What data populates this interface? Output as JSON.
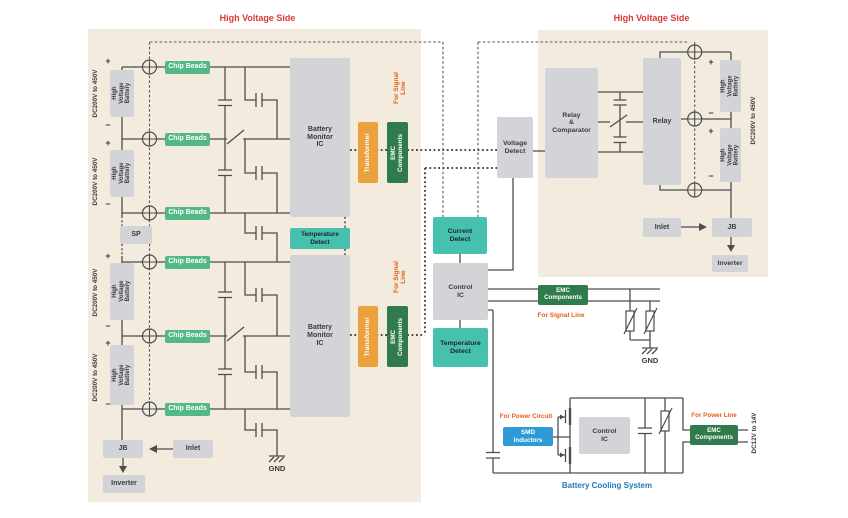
{
  "left": {
    "title": "High Voltage Side",
    "dc_range": "DC200V to 450V",
    "battery": "High Voltage\nBattery",
    "chip_beads": "Chip Beads",
    "sp": "SP",
    "bmic": "Battery\nMonitor\nIC",
    "temp_detect": "Temperature\nDetect",
    "transformer": "Transformer",
    "emc": "EMC\nComponents",
    "signal_line": "For Signal Line",
    "jb": "JB",
    "inlet": "Inlet",
    "inverter": "Inverter",
    "gnd": "GND"
  },
  "middle": {
    "voltage_detect": "Voltage\nDetect",
    "current_detect": "Current\nDetect",
    "control_ic": "Control\nIC",
    "temp_detect": "Temperature\nDetect",
    "emc": "EMC\nComponents",
    "signal_line": "For Signal Line",
    "gnd": "GND"
  },
  "right": {
    "title": "High Voltage Side",
    "relay_comparator": "Relay\n&\nComparator",
    "relay": "Relay",
    "battery": "High Voltage\nBattery",
    "dc_range": "DC200V to 450V",
    "inlet": "Inlet",
    "jb": "JB",
    "inverter": "Inverter"
  },
  "cooling": {
    "title": "Battery Cooling System",
    "power_circuit": "For Power Circuit",
    "smd": "SMD\nInductors",
    "control_ic": "Control\nIC",
    "power_line": "For Power Line",
    "emc": "EMC\nComponents",
    "dc_range": "DC12V to 14V"
  },
  "sym": {
    "plus": "+",
    "minus": "−"
  },
  "colors": {
    "beige": "#F2EBDE",
    "box_gray": "#D2D4D8",
    "box_teal": "#46C1AD",
    "box_green": "#54B788",
    "box_dgreen": "#2F7B4C",
    "box_orange": "#EBA23E",
    "box_blue": "#2D9BD5",
    "red": "#DC3A34",
    "onote": "#E2601C",
    "bluet": "#1E79BE",
    "wire": "#4D4D4D",
    "text_dark": "#3B3B3B"
  }
}
